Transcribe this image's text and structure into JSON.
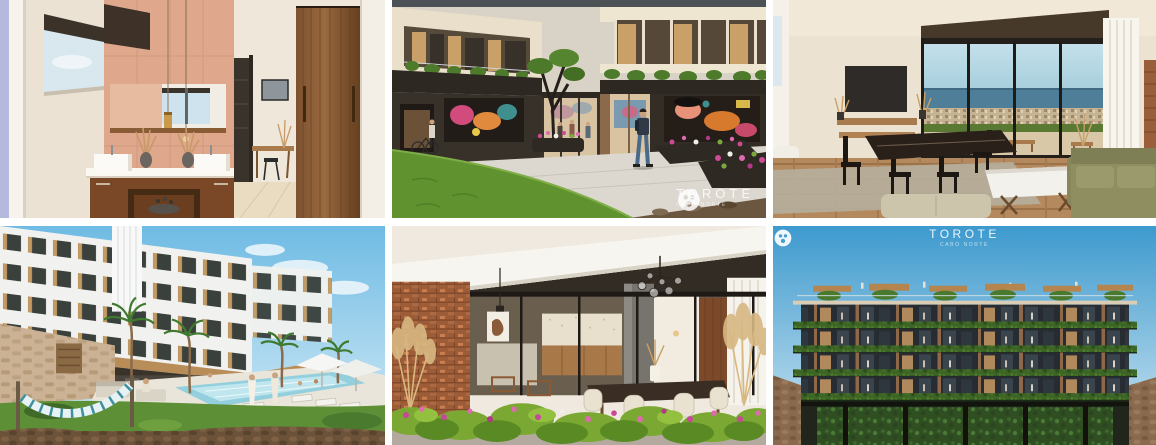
{
  "brand": {
    "name": "TOROTE",
    "tagline": "CABO NORTE",
    "watermark_color": "#ffffff"
  },
  "gallery": {
    "tiles": [
      {
        "id": "bathroom",
        "alt": "Bathroom vanity with double sinks, long mirror, terracotta tile wall and walnut door"
      },
      {
        "id": "courtyard",
        "alt": "Courtyard between residential buildings with murals, planters, lawn and people walking"
      },
      {
        "id": "living",
        "alt": "Living and dining room with floor-to-ceiling windows overlooking the sea"
      },
      {
        "id": "pool",
        "alt": "Resort pool deck with white condo building, palm trees, loungers and hammock"
      },
      {
        "id": "terrace",
        "alt": "Terrace with flowering planters, brick wall and glazed dining interior"
      },
      {
        "id": "facade",
        "alt": "Front elevation of building with planted balcony edges and rooftop pergolas"
      }
    ]
  }
}
